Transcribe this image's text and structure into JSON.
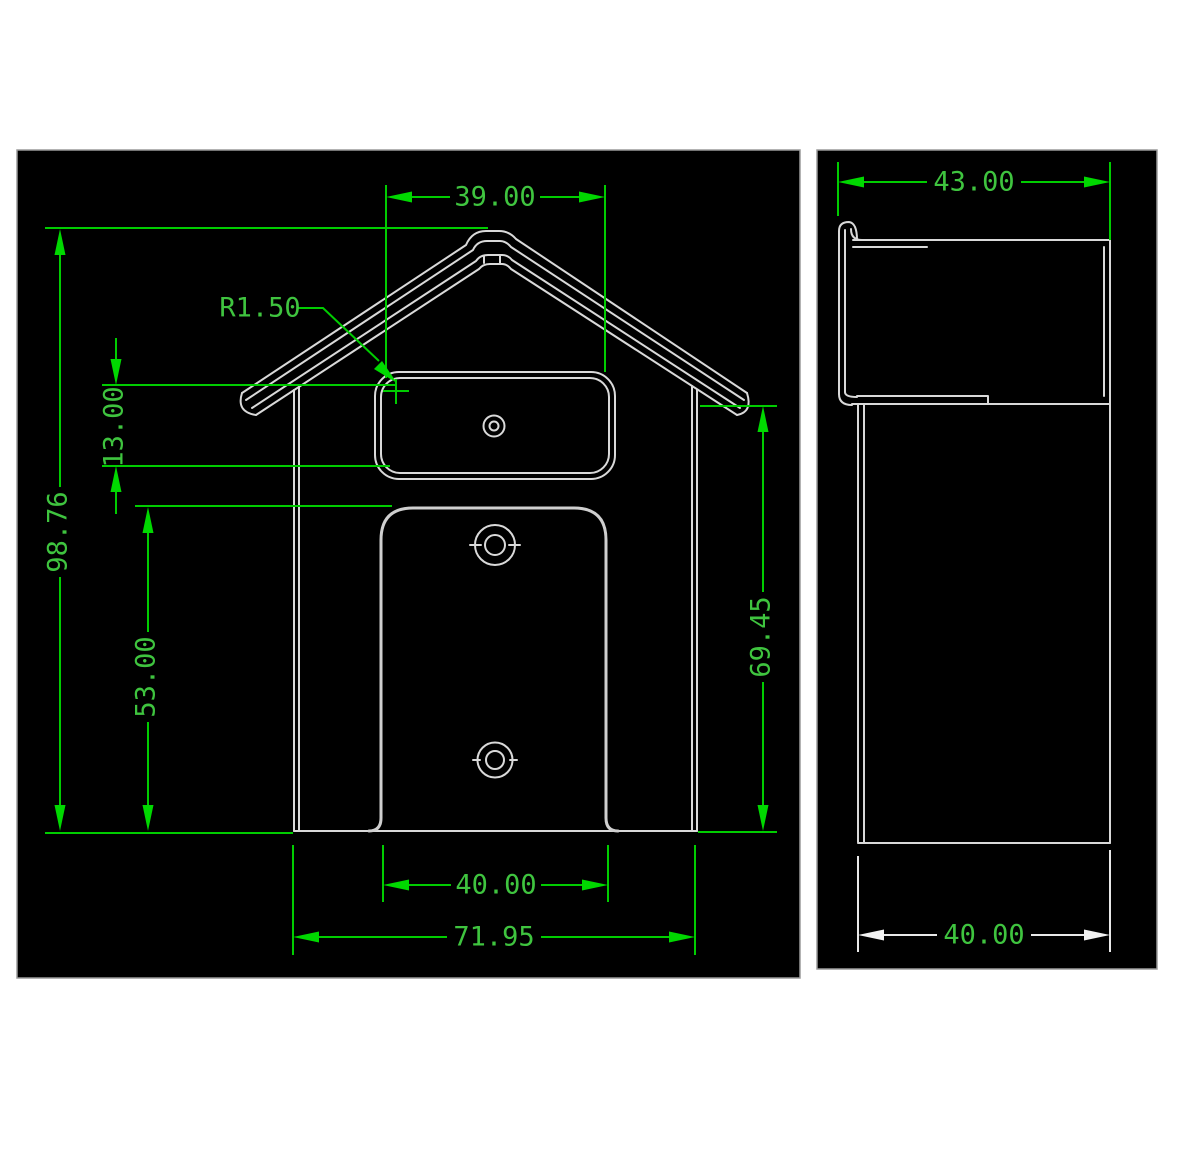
{
  "drawing": {
    "front_view": {
      "top_width": "39.00",
      "fillet_radius": "R1.50",
      "slot_height": "13.00",
      "overall_height": "98.76",
      "channel_height": "53.00",
      "body_height": "69.45",
      "channel_width": "40.00",
      "overall_width": "71.95"
    },
    "side_view": {
      "top_depth": "43.00",
      "base_depth": "40.00"
    },
    "colors": {
      "background": "#ffffff",
      "panel_background": "#000000",
      "dimension_green": "#00cc00",
      "dimension_text_green": "#3fc43f",
      "part_outline_gray": "#d9d9d9",
      "side_dim_white": "#e8e8e8"
    }
  }
}
